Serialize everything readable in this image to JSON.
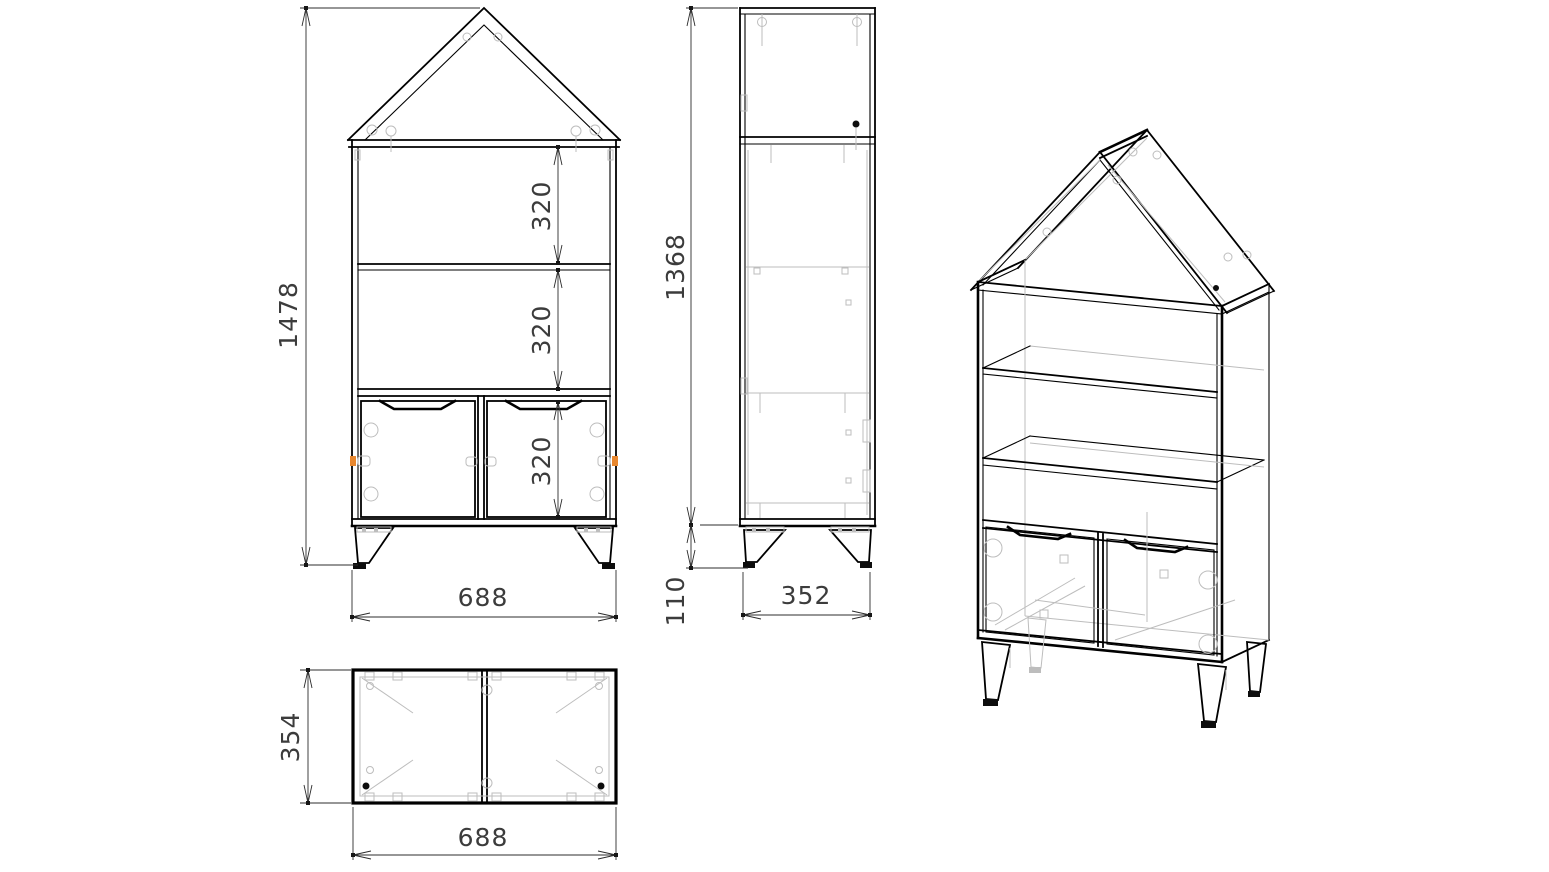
{
  "drawing": {
    "type": "furniture-technical-drawing",
    "object": "house-shaped bookcase with two doors and legs",
    "views": {
      "front": "front-view",
      "side": "side-view",
      "top": "top-view",
      "iso": "isometric-view"
    },
    "colors": {
      "line": "#000000",
      "hidden_line": "#bdbdbd",
      "fitting_accent": "#e8872e",
      "dimension_text": "#3c3c3c",
      "background": "#ffffff"
    }
  },
  "dims": {
    "front_total_height": "1478",
    "front_section_top": "320",
    "front_section_middle": "320",
    "front_section_bottom": "320",
    "front_width": "688",
    "side_body_height": "1368",
    "side_leg_height": "110",
    "side_depth": "352",
    "top_depth": "354",
    "top_width": "688"
  }
}
